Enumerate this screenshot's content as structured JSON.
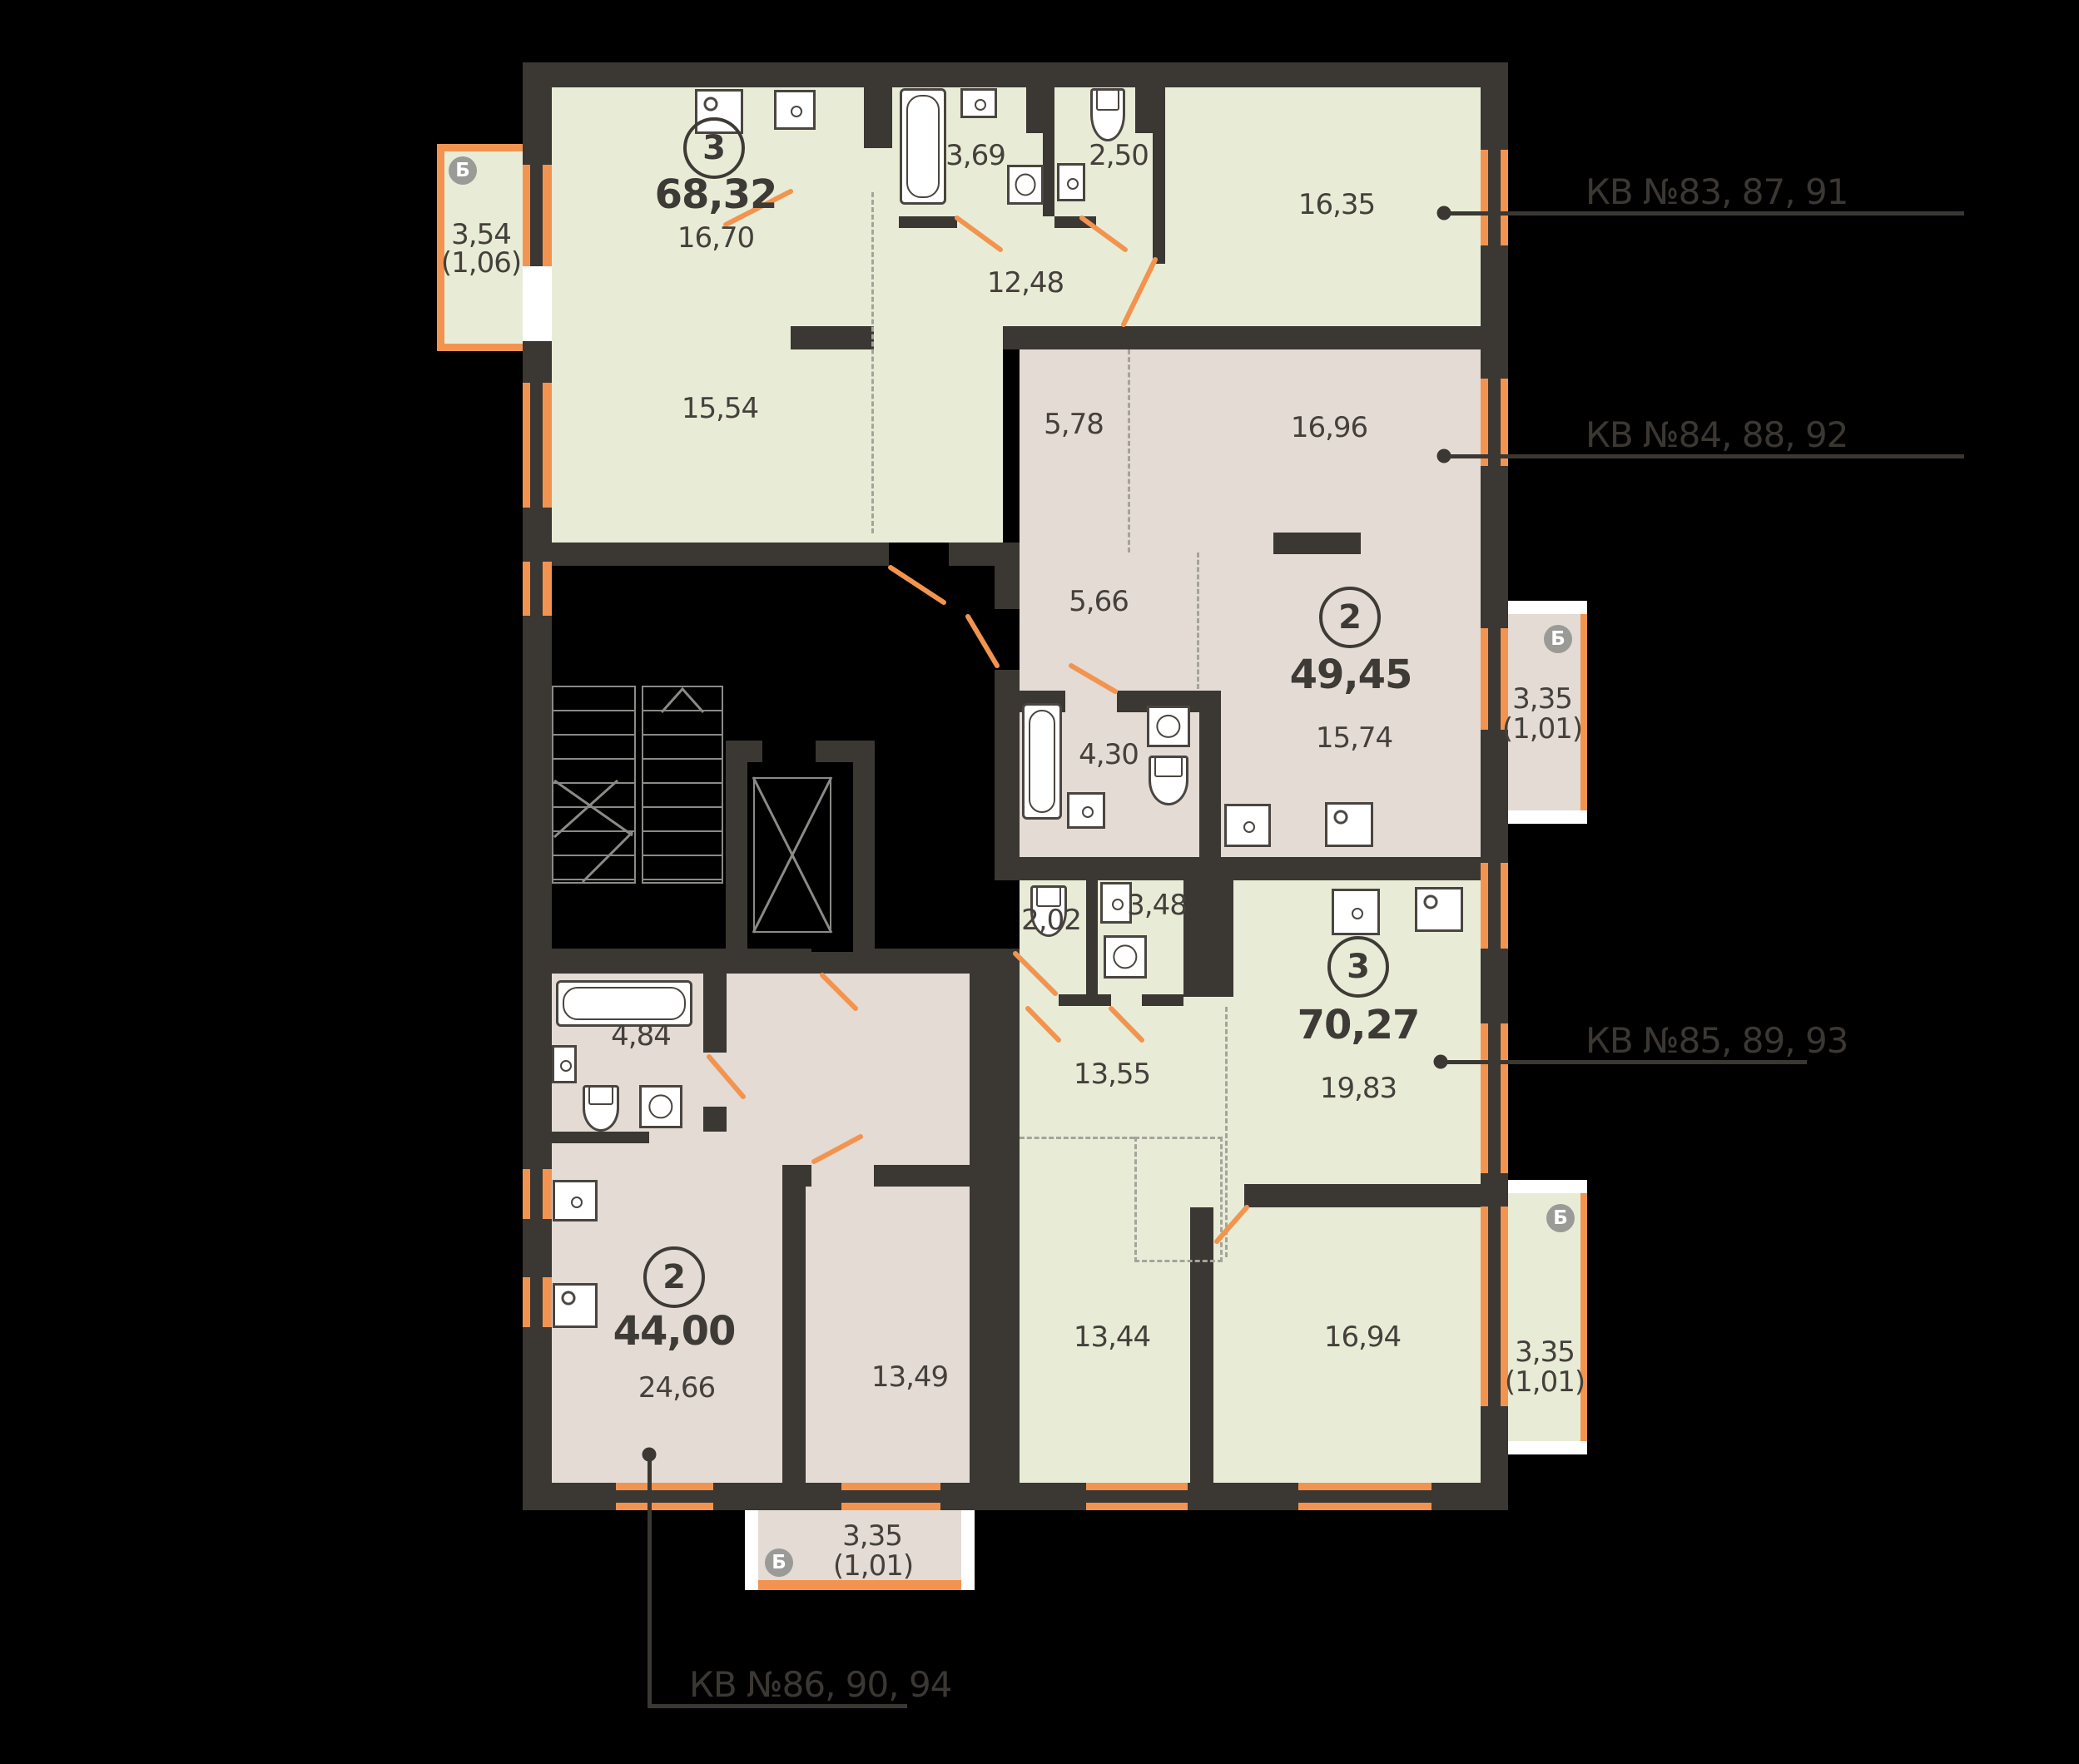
{
  "colors": {
    "background": "#000000",
    "wall": "#3b3733",
    "room_green": "#e8ecd6",
    "room_beige": "#e3dbd4",
    "accent_orange": "#f2944f",
    "text": "#45403c"
  },
  "apartments": {
    "a1": {
      "rooms_count": "3",
      "total_area": "68,32",
      "rooms": {
        "kitchen": "16,70",
        "living": "15,54",
        "bath": "3,69",
        "wc": "2,50",
        "hall": "12,48",
        "bedroom": "16,35"
      },
      "balcony": {
        "tag": "Б",
        "area": "3,54",
        "reduced": "(1,06)"
      }
    },
    "a2": {
      "rooms_count": "2",
      "total_area": "49,45",
      "rooms": {
        "hall": "5,78",
        "living": "16,96",
        "corridor": "5,66",
        "bath": "4,30",
        "kitchen": "15,74"
      },
      "balcony": {
        "tag": "Б",
        "area": "3,35",
        "reduced": "(1,01)"
      }
    },
    "a3": {
      "rooms_count": "3",
      "total_area": "70,27",
      "rooms": {
        "wc": "2,02",
        "bath": "3,48",
        "hall": "13,55",
        "kitchen": "19,83",
        "bedroom1": "13,44",
        "bedroom2": "16,94"
      },
      "balcony": {
        "tag": "Б",
        "area": "3,35",
        "reduced": "(1,01)"
      }
    },
    "a4": {
      "rooms_count": "2",
      "total_area": "44,00",
      "rooms": {
        "bath": "4,84",
        "kitchen_living": "24,66",
        "bedroom": "13,49"
      },
      "balcony": {
        "tag": "Б",
        "area": "3,35",
        "reduced": "(1,01)"
      }
    }
  },
  "callouts": {
    "c1": {
      "text": "КВ №83, 87, 91"
    },
    "c2": {
      "text": "КВ №84, 88, 92"
    },
    "c3": {
      "text": "КВ №85, 89, 93"
    },
    "c4": {
      "text": "КВ №86, 90, 94"
    }
  }
}
